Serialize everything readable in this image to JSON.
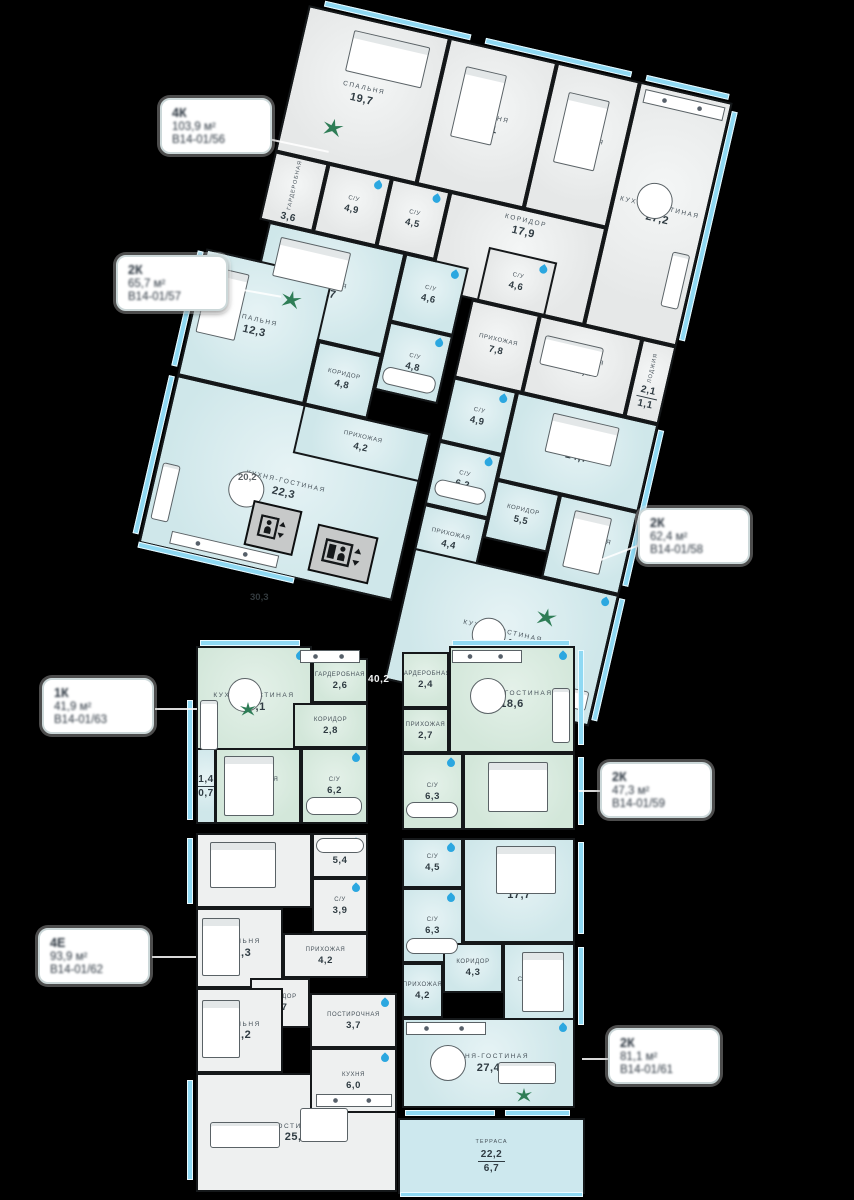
{
  "colors": {
    "wall": "#15181a",
    "apt_gray": "#e6e8e8",
    "apt_teal": "#cfe7ea",
    "apt_green": "#d3e7da",
    "apt_white": "#eef0f0",
    "glazing": "#8fd9f3",
    "drop": "#2ba7e0",
    "plant": "#2e7d56",
    "room_label": "#47525a",
    "area_label": "#2f3b42",
    "background": "#000000"
  },
  "callouts": [
    {
      "type": "4К",
      "area": "103,9 м²",
      "code": "В14-01/56"
    },
    {
      "type": "2К",
      "area": "65,7 м²",
      "code": "В14-01/57"
    },
    {
      "type": "2К",
      "area": "62,4 м²",
      "code": "В14-01/58"
    },
    {
      "type": "1К",
      "area": "41,9 м²",
      "code": "В14-01/63"
    },
    {
      "type": "2К",
      "area": "47,3 м²",
      "code": "В14-01/59"
    },
    {
      "type": "4Е",
      "area": "93,9 м²",
      "code": "В14-01/62"
    },
    {
      "type": "2К",
      "area": "81,1 м²",
      "code": "В14-01/61"
    }
  ],
  "core": {
    "corridor_area": "40,2",
    "hall_a": "20,2",
    "hall_b": "30,3"
  },
  "rooms": {
    "a_sp197": {
      "label": "СПАЛЬНЯ",
      "area": "19,7"
    },
    "a_sp141": {
      "label": "СПАЛЬНЯ",
      "area": "14,1"
    },
    "a_sp142": {
      "label": "СПАЛЬНЯ",
      "area": "14,2"
    },
    "a_kg272": {
      "label": "КУХНЯ-ГОСТИНАЯ",
      "area": "27,2"
    },
    "a_gard36": {
      "label": "ГАРДЕРОБНАЯ",
      "area": "3,6"
    },
    "a_su49": {
      "label": "С/У",
      "area": "4,9"
    },
    "a_su45": {
      "label": "С/У",
      "area": "4,5"
    },
    "a_kor179": {
      "label": "КОРИДОР",
      "area": "17,9"
    },
    "a_su46": {
      "label": "С/У",
      "area": "4,6"
    },
    "a_pri78": {
      "label": "ПРИХОЖАЯ",
      "area": "7,8"
    },
    "a_sp112": {
      "label": "СПАЛЬНЯ",
      "area": "11,2"
    },
    "a_lod": {
      "label": "ЛОДЖИЯ",
      "area": "2,1",
      "area2": "1,1"
    },
    "b_sp167": {
      "label": "СПАЛЬНЯ",
      "area": "16,7"
    },
    "b_su46": {
      "label": "С/У",
      "area": "4,6"
    },
    "b_su48": {
      "label": "С/У",
      "area": "4,8"
    },
    "b_kor48": {
      "label": "КОРИДОР",
      "area": "4,8"
    },
    "b_sp123": {
      "label": "СПАЛЬНЯ",
      "area": "12,3"
    },
    "b_pri42": {
      "label": "ПРИХОЖАЯ",
      "area": "4,2"
    },
    "b_kg223": {
      "label": "КУХНЯ-ГОСТИНАЯ",
      "area": "22,3"
    },
    "c_su49": {
      "label": "С/У",
      "area": "4,9"
    },
    "c_sp147": {
      "label": "СПАЛЬНЯ",
      "area": "14,7"
    },
    "c_su62": {
      "label": "С/У",
      "area": "6,2"
    },
    "c_kor55": {
      "label": "КОРИДОР",
      "area": "5,5"
    },
    "c_sp120": {
      "label": "СПАЛЬНЯ",
      "area": "12,0"
    },
    "c_pri44": {
      "label": "ПРИХОЖАЯ",
      "area": "4,4"
    },
    "c_kg214": {
      "label": "КУХНЯ-ГОСТИНАЯ",
      "area": "21,4"
    },
    "d_kg171": {
      "label": "КУХНЯ-ГОСТИНАЯ",
      "area": "17,1"
    },
    "d_gard26": {
      "label": "ГАРДЕРОБНАЯ",
      "area": "2,6"
    },
    "d_kor28": {
      "label": "КОРИДОР",
      "area": "2,8"
    },
    "d_sp122": {
      "label": "СПАЛЬНЯ",
      "area": "12,2"
    },
    "d_su62": {
      "label": "С/У",
      "area": "6,2"
    },
    "d_lod": {
      "label": "ЛОДЖИЯ",
      "area": "1,4",
      "area2": "0,7"
    },
    "e_gard24": {
      "label": "ГАРДЕРОБНАЯ",
      "area": "2,4"
    },
    "e_pri27": {
      "label": "ПРИХОЖАЯ",
      "area": "2,7"
    },
    "e_kg186": {
      "label": "КУХНЯ-ГОСТИНАЯ",
      "area": "18,6"
    },
    "e_su63": {
      "label": "С/У",
      "area": "6,3"
    },
    "e_sp170": {
      "label": "СПАЛЬНЯ",
      "area": "17,0"
    },
    "f_sp169": {
      "label": "СПАЛЬНЯ",
      "area": "16,9"
    },
    "f_su54": {
      "label": "С/У",
      "area": "5,4"
    },
    "f_su39": {
      "label": "С/У",
      "area": "3,9"
    },
    "f_sp123": {
      "label": "СПАЛЬНЯ",
      "area": "12,3"
    },
    "f_pri42": {
      "label": "ПРИХОЖАЯ",
      "area": "4,2"
    },
    "f_kor87": {
      "label": "КОРИДОР",
      "area": "8,7"
    },
    "f_sp122": {
      "label": "СПАЛЬНЯ",
      "area": "12,2"
    },
    "f_post37": {
      "label": "ПОСТИРОЧНАЯ",
      "area": "3,7"
    },
    "f_kuh60": {
      "label": "КУХНЯ",
      "area": "6,0"
    },
    "f_gost257": {
      "label": "ГОСТИНАЯ",
      "area": "25,7"
    },
    "g_su45": {
      "label": "С/У",
      "area": "4,5"
    },
    "g_sp177": {
      "label": "СПАЛЬНЯ",
      "area": "17,7"
    },
    "g_su63": {
      "label": "С/У",
      "area": "6,3"
    },
    "g_kor43": {
      "label": "КОРИДОР",
      "area": "4,3"
    },
    "g_sp130": {
      "label": "СПАЛЬНЯ",
      "area": "13,0"
    },
    "g_pri42": {
      "label": "ПРИХОЖАЯ",
      "area": "4,2"
    },
    "g_kg274": {
      "label": "КУХНЯ-ГОСТИНАЯ",
      "area": "27,4"
    },
    "terrace": {
      "label": "ТЕРРАСА",
      "area": "22,2",
      "area2": "6,7"
    }
  }
}
